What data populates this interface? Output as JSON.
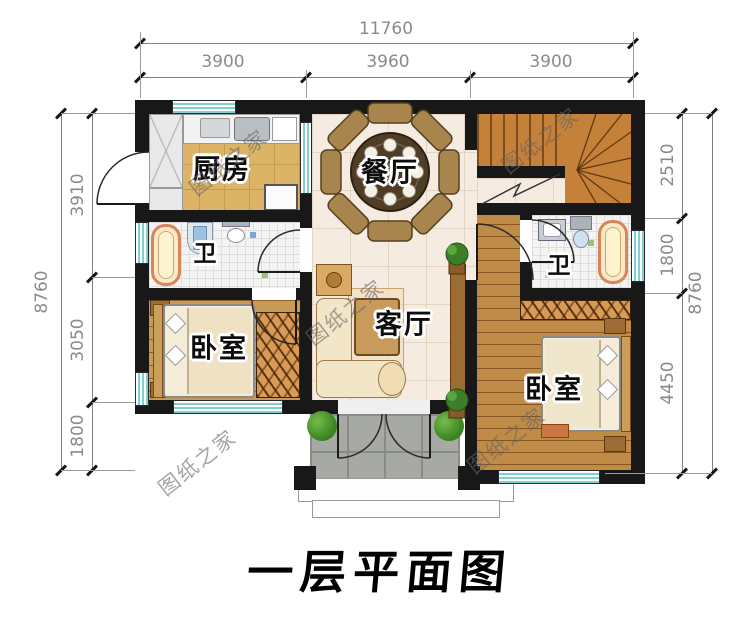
{
  "title": "一层平面图",
  "watermark_text": "图纸之家",
  "dimensions": {
    "top_overall": "11760",
    "top_segments": [
      "3900",
      "3960",
      "3900"
    ],
    "left_overall": "8760",
    "left_segments": [
      "3910",
      "3050",
      "1800"
    ],
    "right_segments": [
      "2510",
      "1800",
      "4450"
    ],
    "right_overall": "8760"
  },
  "rooms": {
    "kitchen": "厨房",
    "dining": "餐厅",
    "living": "客厅",
    "bath_left": "卫",
    "bath_right": "卫",
    "bedroom_left": "卧室",
    "bedroom_right": "卧室"
  },
  "colors": {
    "wall": "#181818",
    "window_teal": "#82cfcf",
    "kitchen_floor": "#dcb468",
    "tile_floor": "#f5ebe0",
    "wood_floor": "#c89a58",
    "stairs_wood": "#c5813a",
    "porch_gray": "#a7aaa4",
    "dimension_gray": "#8a8a8a"
  }
}
